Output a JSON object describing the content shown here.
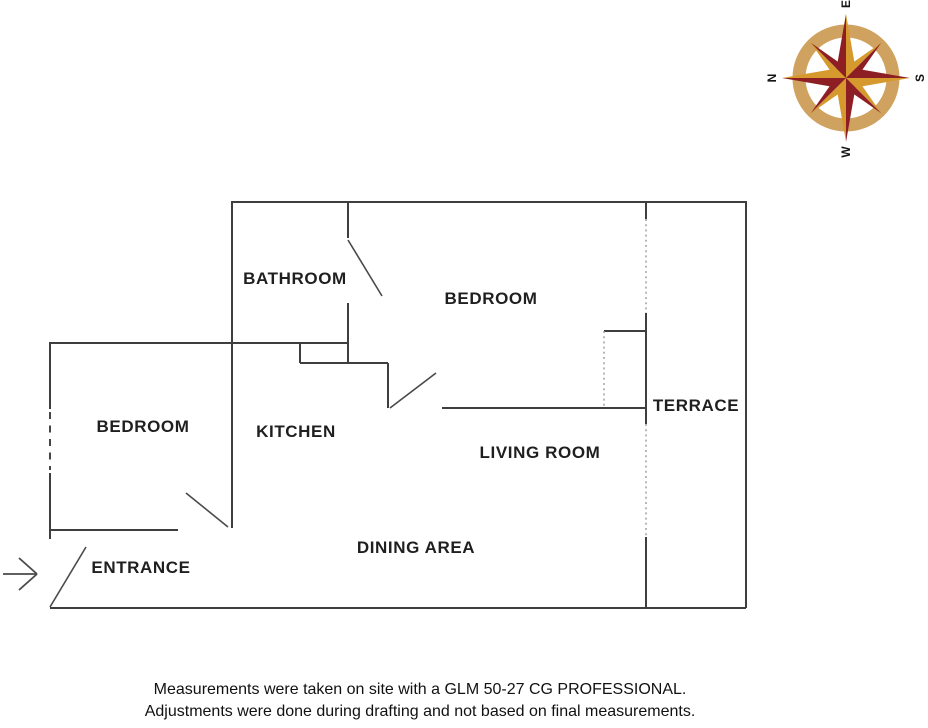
{
  "rooms": {
    "bathroom": "BATHROOM",
    "bedroom_top": "BEDROOM",
    "bedroom_left": "BEDROOM",
    "kitchen": "KITCHEN",
    "living_room": "LIVING ROOM",
    "terrace": "TERRACE",
    "dining_area": "DINING AREA",
    "entrance": "ENTRANCE"
  },
  "compass": {
    "letters": {
      "n": "N",
      "e": "E",
      "s": "S",
      "w": "W"
    },
    "colors": {
      "ring": "#D0A25F",
      "dark": "#8D1F24",
      "gold": "#D6992E"
    }
  },
  "footer": {
    "line1": "Measurements were taken on site with a GLM 50-27 CG PROFESSIONAL.",
    "line2": "Adjustments were done during drafting and not based on final measurements."
  }
}
